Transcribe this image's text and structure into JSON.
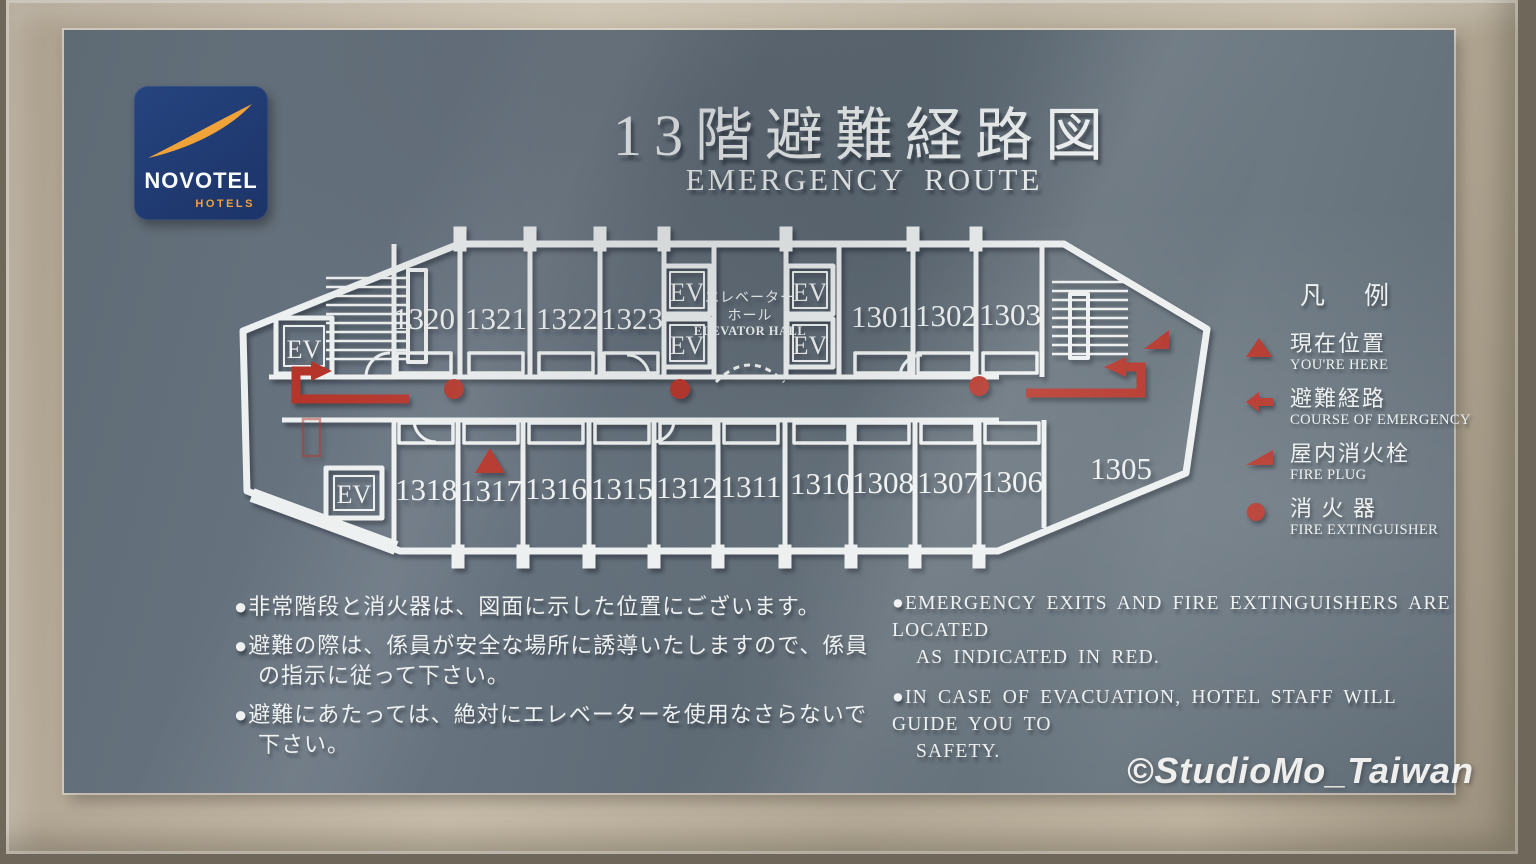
{
  "sign": {
    "title_jp": "13階避難経路図",
    "title_en": "EMERGENCY ROUTE"
  },
  "logo": {
    "brand": "NOVOTEL",
    "sub": "HOTELS"
  },
  "floorplan": {
    "ev": "EV",
    "rooms_top_left": [
      "1320",
      "1321",
      "1322",
      "1323"
    ],
    "rooms_top_right": [
      "1301",
      "1302",
      "1303"
    ],
    "rooms_bottom": [
      "1318",
      "1317",
      "1316",
      "1315",
      "1312",
      "1311",
      "1310",
      "1308",
      "1307",
      "1306"
    ],
    "room_corner": "1305",
    "hall": {
      "jp1": "エレベーター",
      "jp2": "ホール",
      "en": "ELEVATOR HALL"
    }
  },
  "legend": {
    "heading": "凡　例",
    "items": [
      {
        "icon": "you-are-here-triangle-icon",
        "jp": "現在位置",
        "en": "YOU'RE HERE"
      },
      {
        "icon": "evacuation-route-arrow-icon",
        "jp": "避難経路",
        "en": "COURSE OF EMERGENCY"
      },
      {
        "icon": "fire-plug-flag-icon",
        "jp": "屋内消火栓",
        "en": "FIRE PLUG"
      },
      {
        "icon": "fire-extinguisher-dot-icon",
        "jp": "消 火 器",
        "en": "FIRE EXTINGUISHER"
      }
    ]
  },
  "notes_jp": {
    "lines": [
      "●非常階段と消火器は、図面に示した位置にございます。",
      "●避難の際は、係員が安全な場所に誘導いたしますので、係員",
      "の指示に従って下さい。",
      "●避難にあたっては、絶対にエレベーターを使用なさらないで",
      "下さい。"
    ]
  },
  "notes_en": {
    "lines": [
      "●EMERGENCY EXITS AND FIRE EXTINGUISHERS ARE LOCATED",
      "AS INDICATED IN RED.",
      "●IN CASE OF EVACUATION, HOTEL STAFF WILL GUIDE YOU TO",
      "SAFETY."
    ]
  },
  "watermark": "©StudioMo_Taiwan",
  "colors": {
    "panel": "#64707a",
    "frame": "#b7ac99",
    "accent_red": "#b5352a",
    "sign_white": "#eef1f1",
    "novotel_blue": "#203c7a",
    "novotel_orange": "#f0a339"
  }
}
